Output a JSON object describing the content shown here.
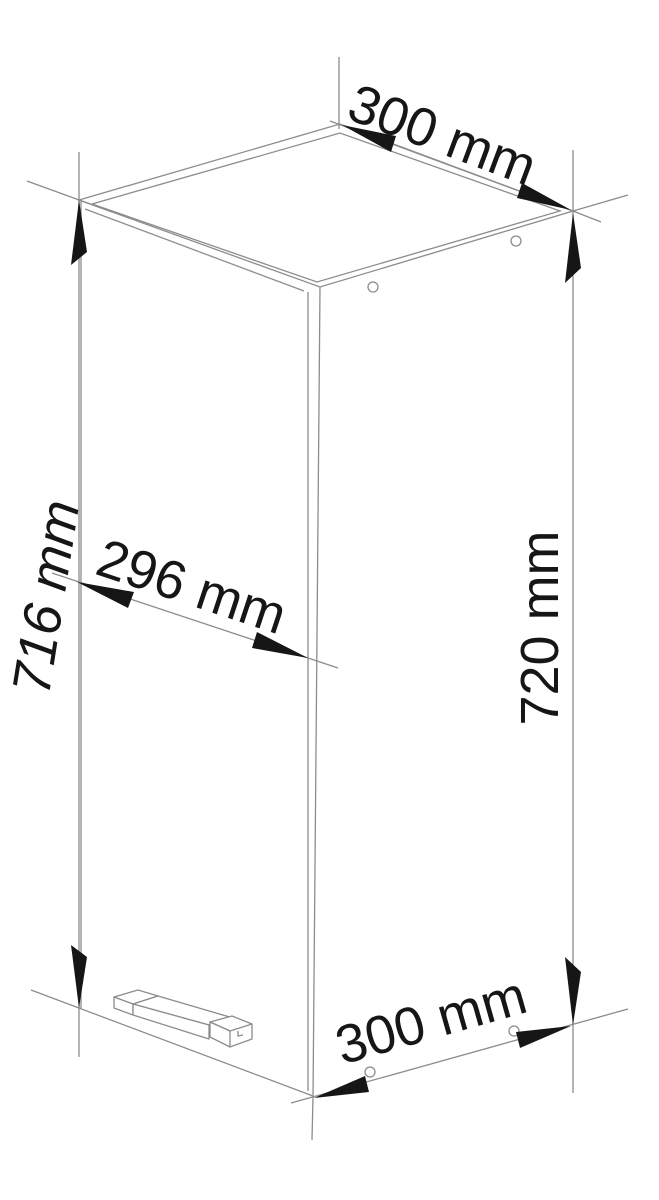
{
  "drawing": {
    "labels": {
      "top_width": "300 mm",
      "door_width": "296 mm",
      "door_height": "716 mm",
      "side_height": "720 mm",
      "bottom_depth": "300 mm"
    },
    "colors": {
      "line": "#8c8c8c",
      "ink": "#161616",
      "background": "#ffffff"
    }
  }
}
